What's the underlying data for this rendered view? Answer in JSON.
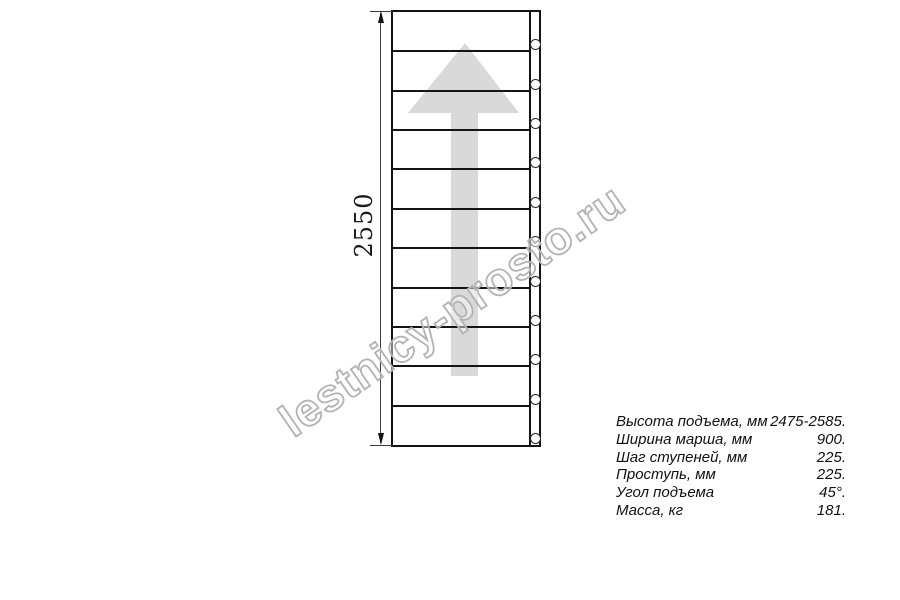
{
  "drawing": {
    "dimension_label": "2550",
    "tread_count": 11,
    "hole_count": 11,
    "arrow_direction": "up",
    "colors": {
      "line": "#141414",
      "arrow_fill": "#d9d9d9",
      "watermark_stroke": "#b3b3b3"
    }
  },
  "watermark": {
    "text": "lestnicy-prosto.ru"
  },
  "specs": {
    "rows": [
      {
        "label": "Высота подъема, мм",
        "value": "2475-2585."
      },
      {
        "label": "Ширина марша, мм",
        "value": "900."
      },
      {
        "label": "Шаг ступеней, мм",
        "value": "225."
      },
      {
        "label": "Проступь, мм",
        "value": "225."
      },
      {
        "label": "Угол подъема",
        "value": "45°."
      },
      {
        "label": "Масса, кг",
        "value": "181."
      }
    ]
  }
}
